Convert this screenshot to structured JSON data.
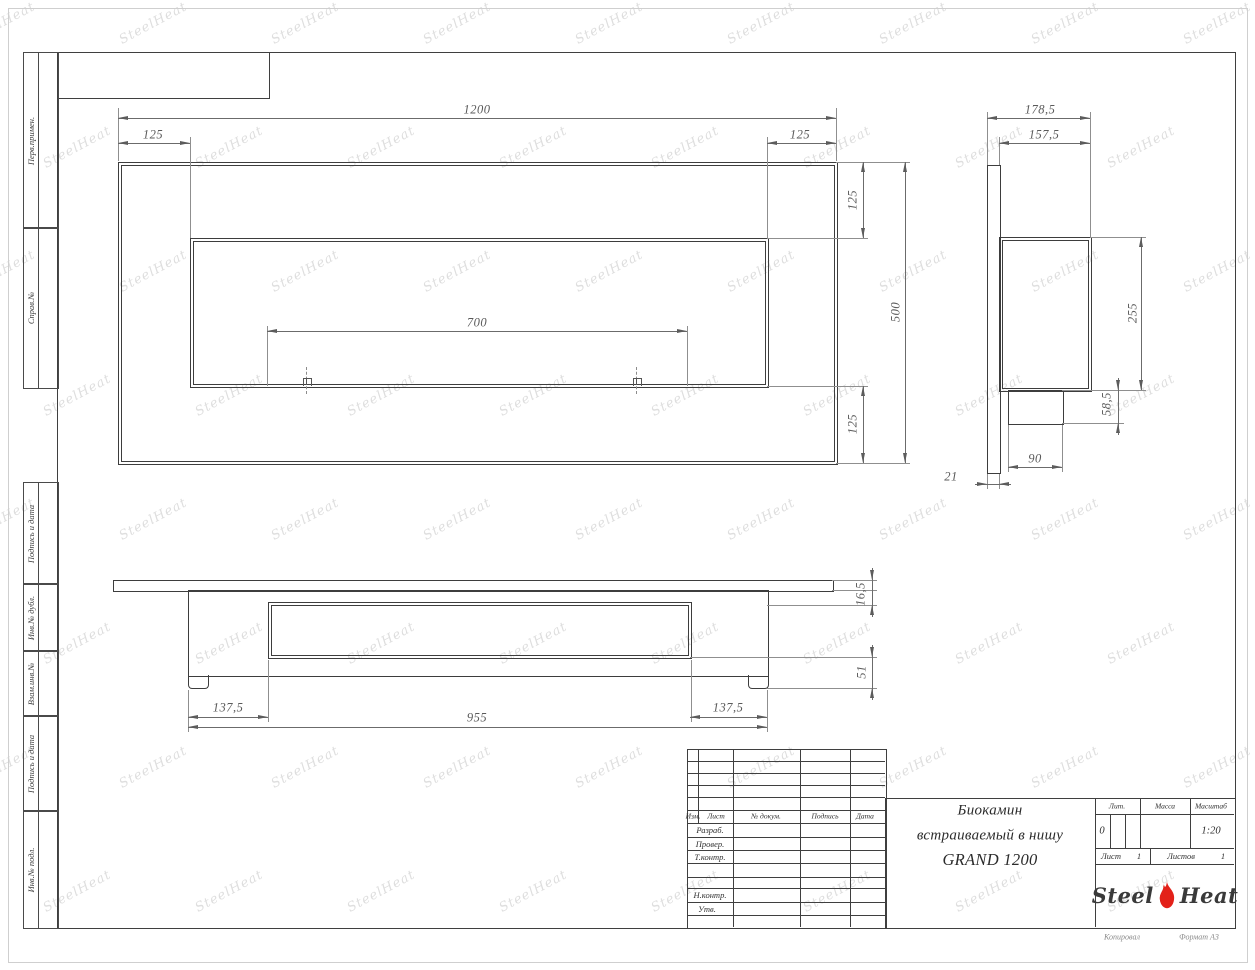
{
  "colors": {
    "line": "#3f3f3f",
    "dim_text": "#5a5a5a",
    "flame_red": "#e32119",
    "flame_dark": "#a31309",
    "watermark": "#dedede"
  },
  "watermark": {
    "text": "SteelHeat"
  },
  "margin_labels": [
    "Перв.примен.",
    "Справ.№",
    "Подпись и дата",
    "Инв.№ дубл.",
    "Взам.инв.№",
    "Подпись и дата",
    "Инв.№ подл."
  ],
  "views": {
    "front": {
      "dim_width": "1200",
      "dim_left_inset": "125",
      "dim_right_inset": "125",
      "dim_burner_span": "700",
      "dim_top_inset": "125",
      "dim_height": "500",
      "dim_bottom_inset": "125"
    },
    "side": {
      "dim_depth_total": "178,5",
      "dim_depth_body": "157,5",
      "dim_body_height": "255",
      "dim_ledge_height": "58,5",
      "dim_ledge_depth": "90",
      "dim_panel_thickness": "21"
    },
    "bottom": {
      "dim_edge_left": "137,5",
      "dim_body_width": "955",
      "dim_edge_right": "137,5",
      "dim_panel_thickness": "16,5",
      "dim_depth": "51"
    }
  },
  "title_block": {
    "header": {
      "izm": "Изм.",
      "list": "Лист",
      "doc": "№ докум.",
      "podpis": "Подпись",
      "data": "Дата"
    },
    "rows": {
      "razrab": "Разраб.",
      "prover": "Провер.",
      "tkontr": "Т.контр.",
      "nkontr": "Н.контр.",
      "utv": "Утв."
    },
    "title_line1": "Биокамин",
    "title_line2": "встраиваемый в нишу",
    "title_line3": "GRAND 1200",
    "lit_label": "Лит.",
    "lit_value": "0",
    "massa_label": "Масса",
    "masshtab_label": "Масштаб",
    "masshtab_value": "1:20",
    "list_label": "Лист",
    "list_value": "1",
    "listov_label": "Листов",
    "listov_value": "1",
    "logo": {
      "steel": "Steel",
      "heat": "Heat"
    },
    "kopiroval": "Копировал",
    "format": "Формат А3"
  }
}
